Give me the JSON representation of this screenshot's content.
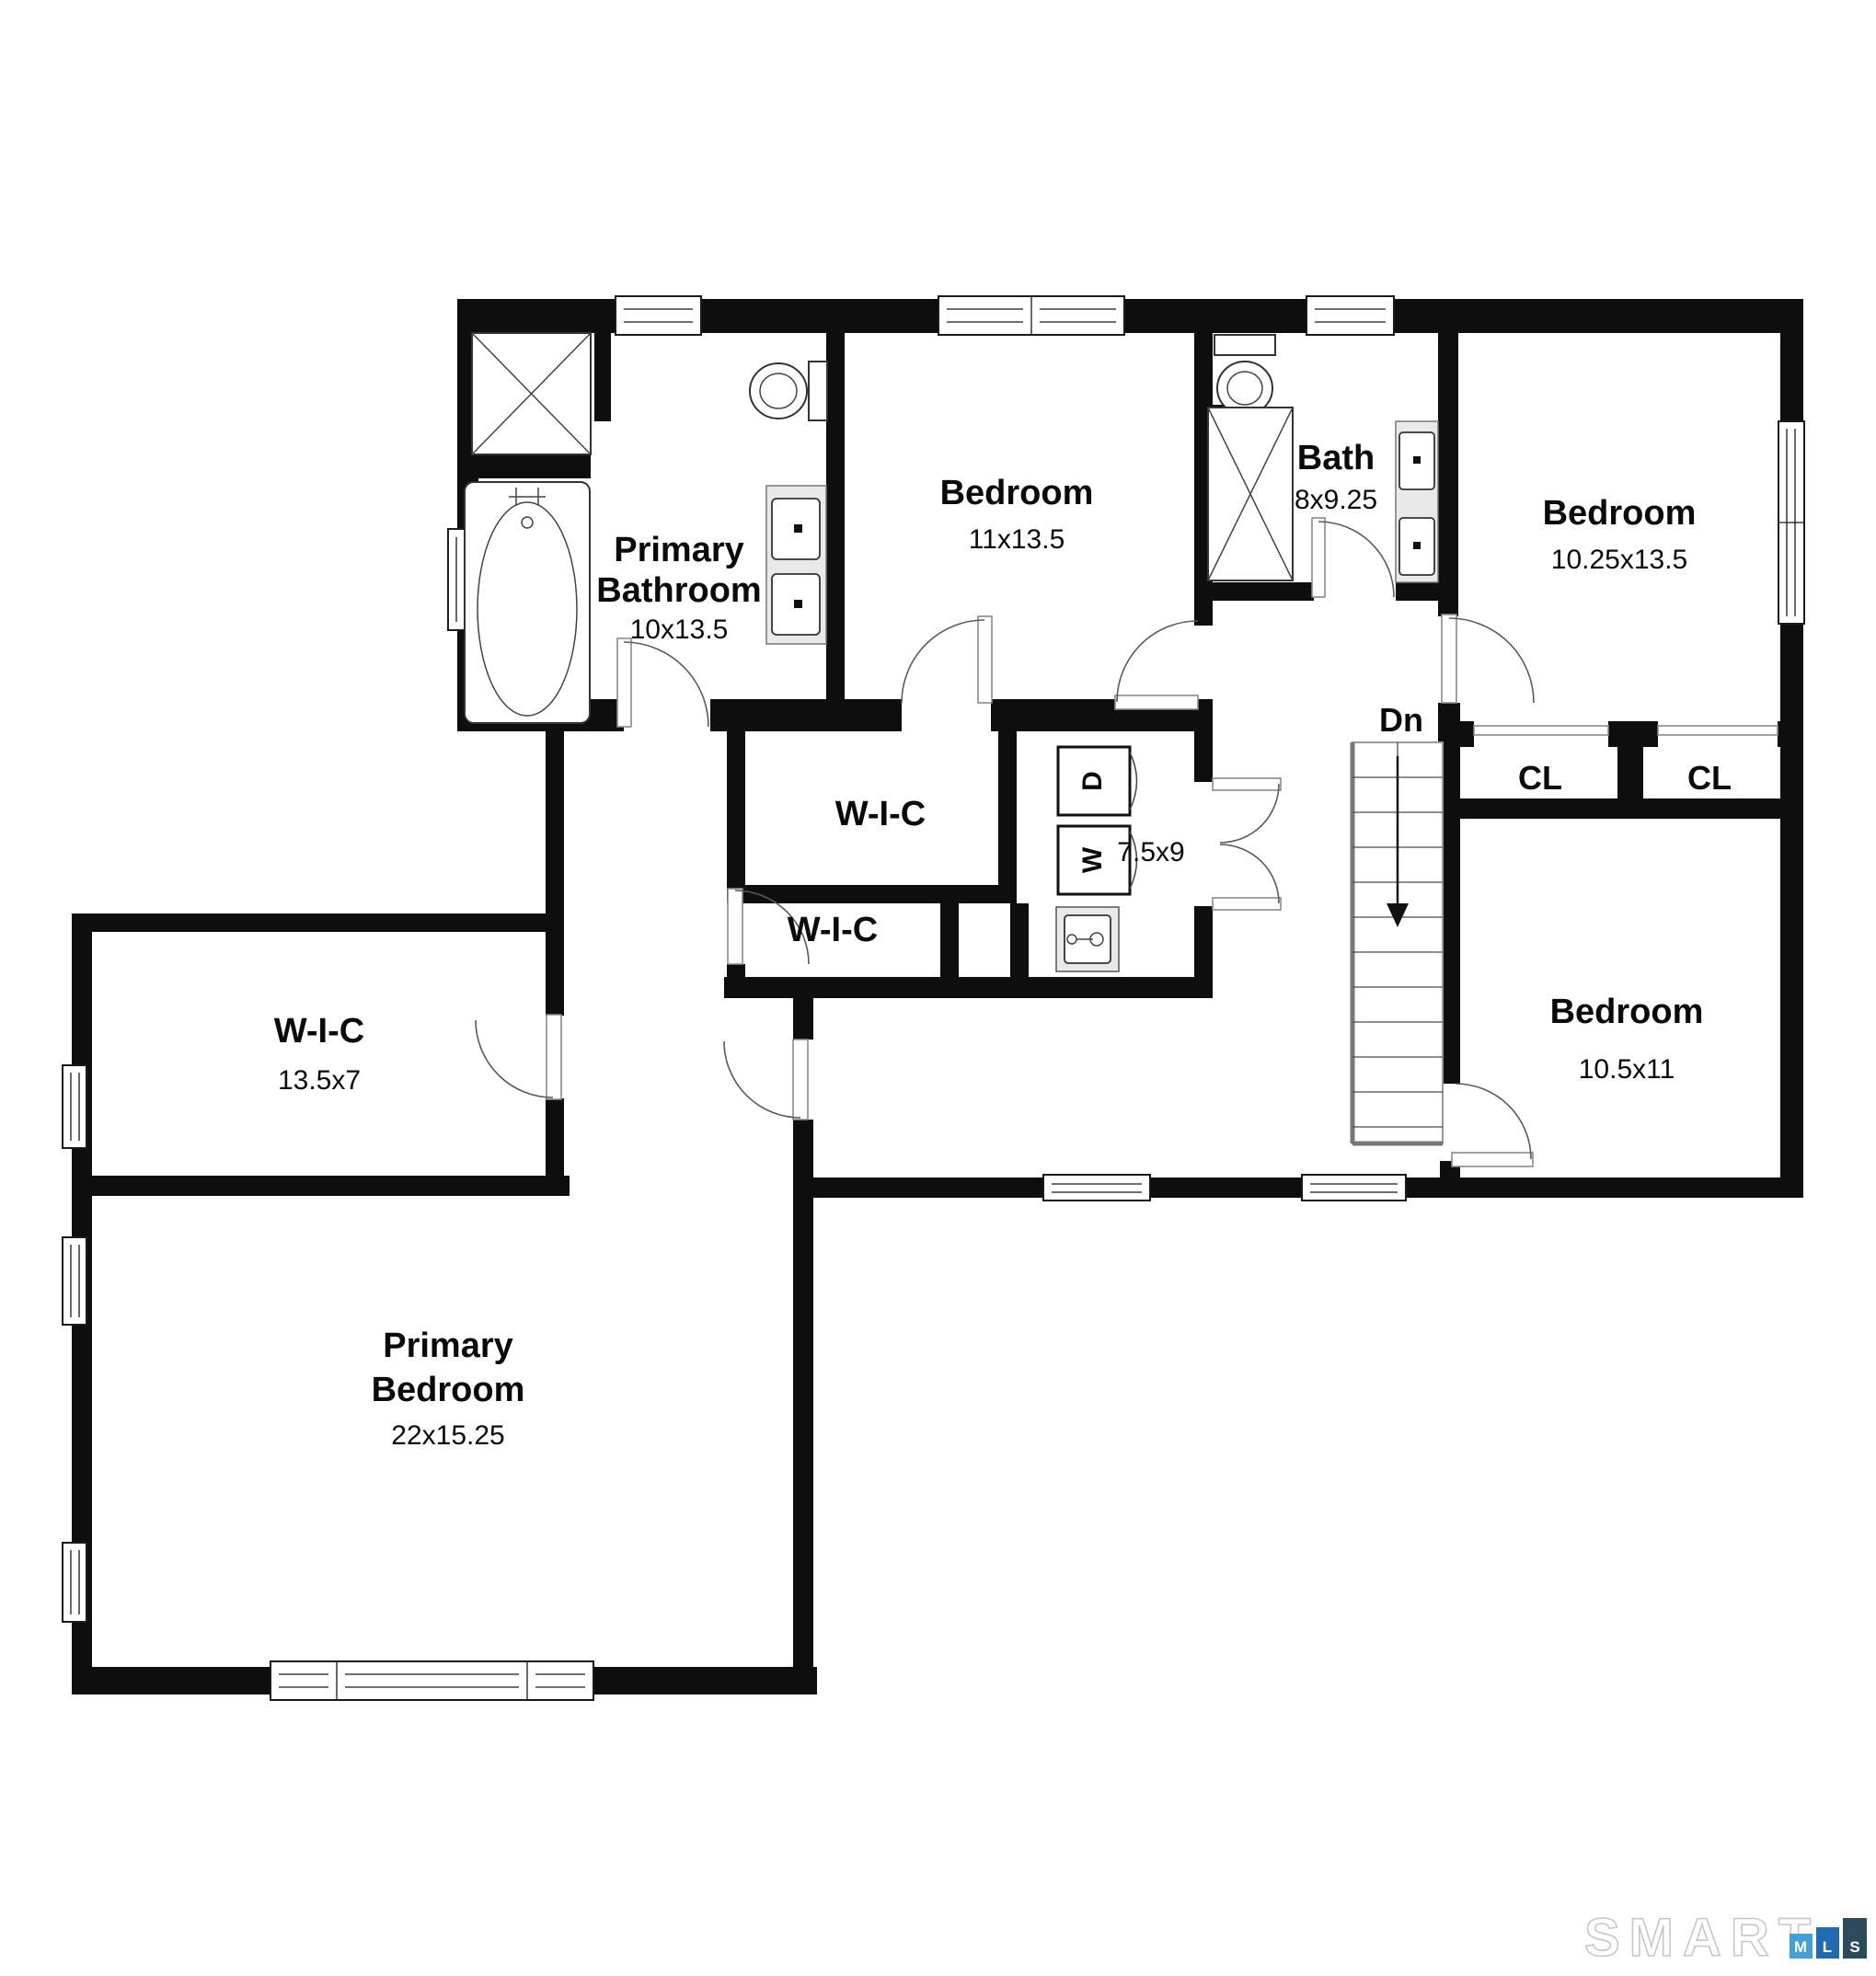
{
  "plan": {
    "rooms": {
      "primary_bathroom": {
        "label1": "Primary",
        "label2": "Bathroom",
        "dims": "10x13.5"
      },
      "bedroom_top": {
        "label": "Bedroom",
        "dims": "11x13.5"
      },
      "bath": {
        "label": "Bath",
        "dims": "8x9.25"
      },
      "bedroom_right": {
        "label": "Bedroom",
        "dims": "10.25x13.5"
      },
      "wic_upper": {
        "label": "W-I-C"
      },
      "wic_lower": {
        "label": "W-I-C"
      },
      "laundry": {
        "dims": "7.5x9"
      },
      "closet1": {
        "label": "CL"
      },
      "closet2": {
        "label": "CL"
      },
      "bedroom_small": {
        "label": "Bedroom",
        "dims": "10.5x11"
      },
      "wic_primary": {
        "label": "W-I-C",
        "dims": "13.5x7"
      },
      "primary_bedroom": {
        "label1": "Primary",
        "label2": "Bedroom",
        "dims": "22x15.25"
      }
    },
    "stairs": {
      "label": "Dn"
    },
    "appliances": {
      "washer": "W",
      "dryer": "D"
    },
    "logo": {
      "word": "SMART",
      "m": "M",
      "l": "L",
      "s": "S",
      "colors": {
        "m": "#41a0d8",
        "l": "#1f6cb3",
        "s": "#2b4a5c"
      }
    }
  }
}
